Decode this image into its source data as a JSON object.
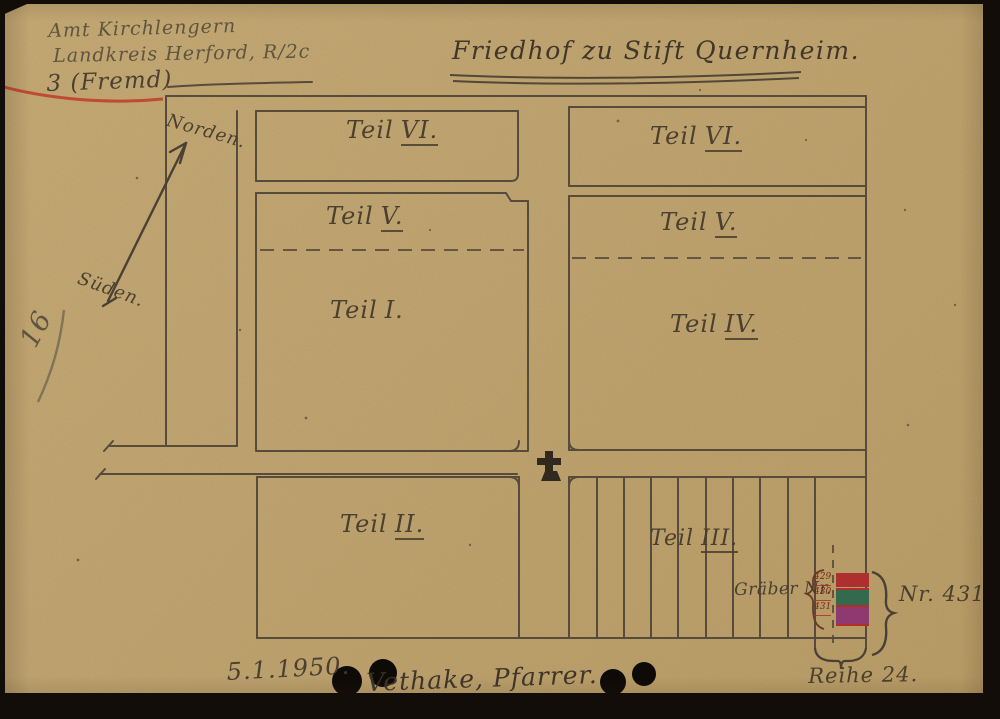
{
  "title": "Friedhof zu Stift Quernheim.",
  "corner_notes": {
    "line1": "Amt Kirchlengern",
    "line2": "Landkreis Herford, R/2c",
    "line3": "3 (Fremd)"
  },
  "margin_number": "16",
  "compass": {
    "north": "Norden.",
    "south": "Süden."
  },
  "sections": {
    "vi_left": {
      "word": "Teil",
      "numeral": "VI."
    },
    "vi_right": {
      "word": "Teil",
      "numeral": "VI."
    },
    "v_left": {
      "word": "Teil",
      "numeral": "V."
    },
    "v_right": {
      "word": "Teil",
      "numeral": "V."
    },
    "i": {
      "word": "Teil",
      "numeral": "I."
    },
    "iv": {
      "word": "Teil",
      "numeral": "IV."
    },
    "ii": {
      "word": "Teil",
      "numeral": "II."
    },
    "iii": {
      "word": "Teil",
      "numeral": "III."
    }
  },
  "graves_annotation": {
    "label": "Gräber Nr.",
    "numbers": [
      "429",
      "430",
      "431"
    ],
    "callout": "Nr. 431.",
    "row_label": "Reihe 24."
  },
  "footer": {
    "date": "5.1.1950.",
    "signature": "Vethake, Pfarrer."
  },
  "colors": {
    "paper": "#c9ab73",
    "ink": "#4f4538",
    "red_ink": "#bf2f28",
    "mark_red": "#ad2f2f",
    "mark_green": "#336a4e",
    "mark_magenta": "#8e3a70"
  }
}
